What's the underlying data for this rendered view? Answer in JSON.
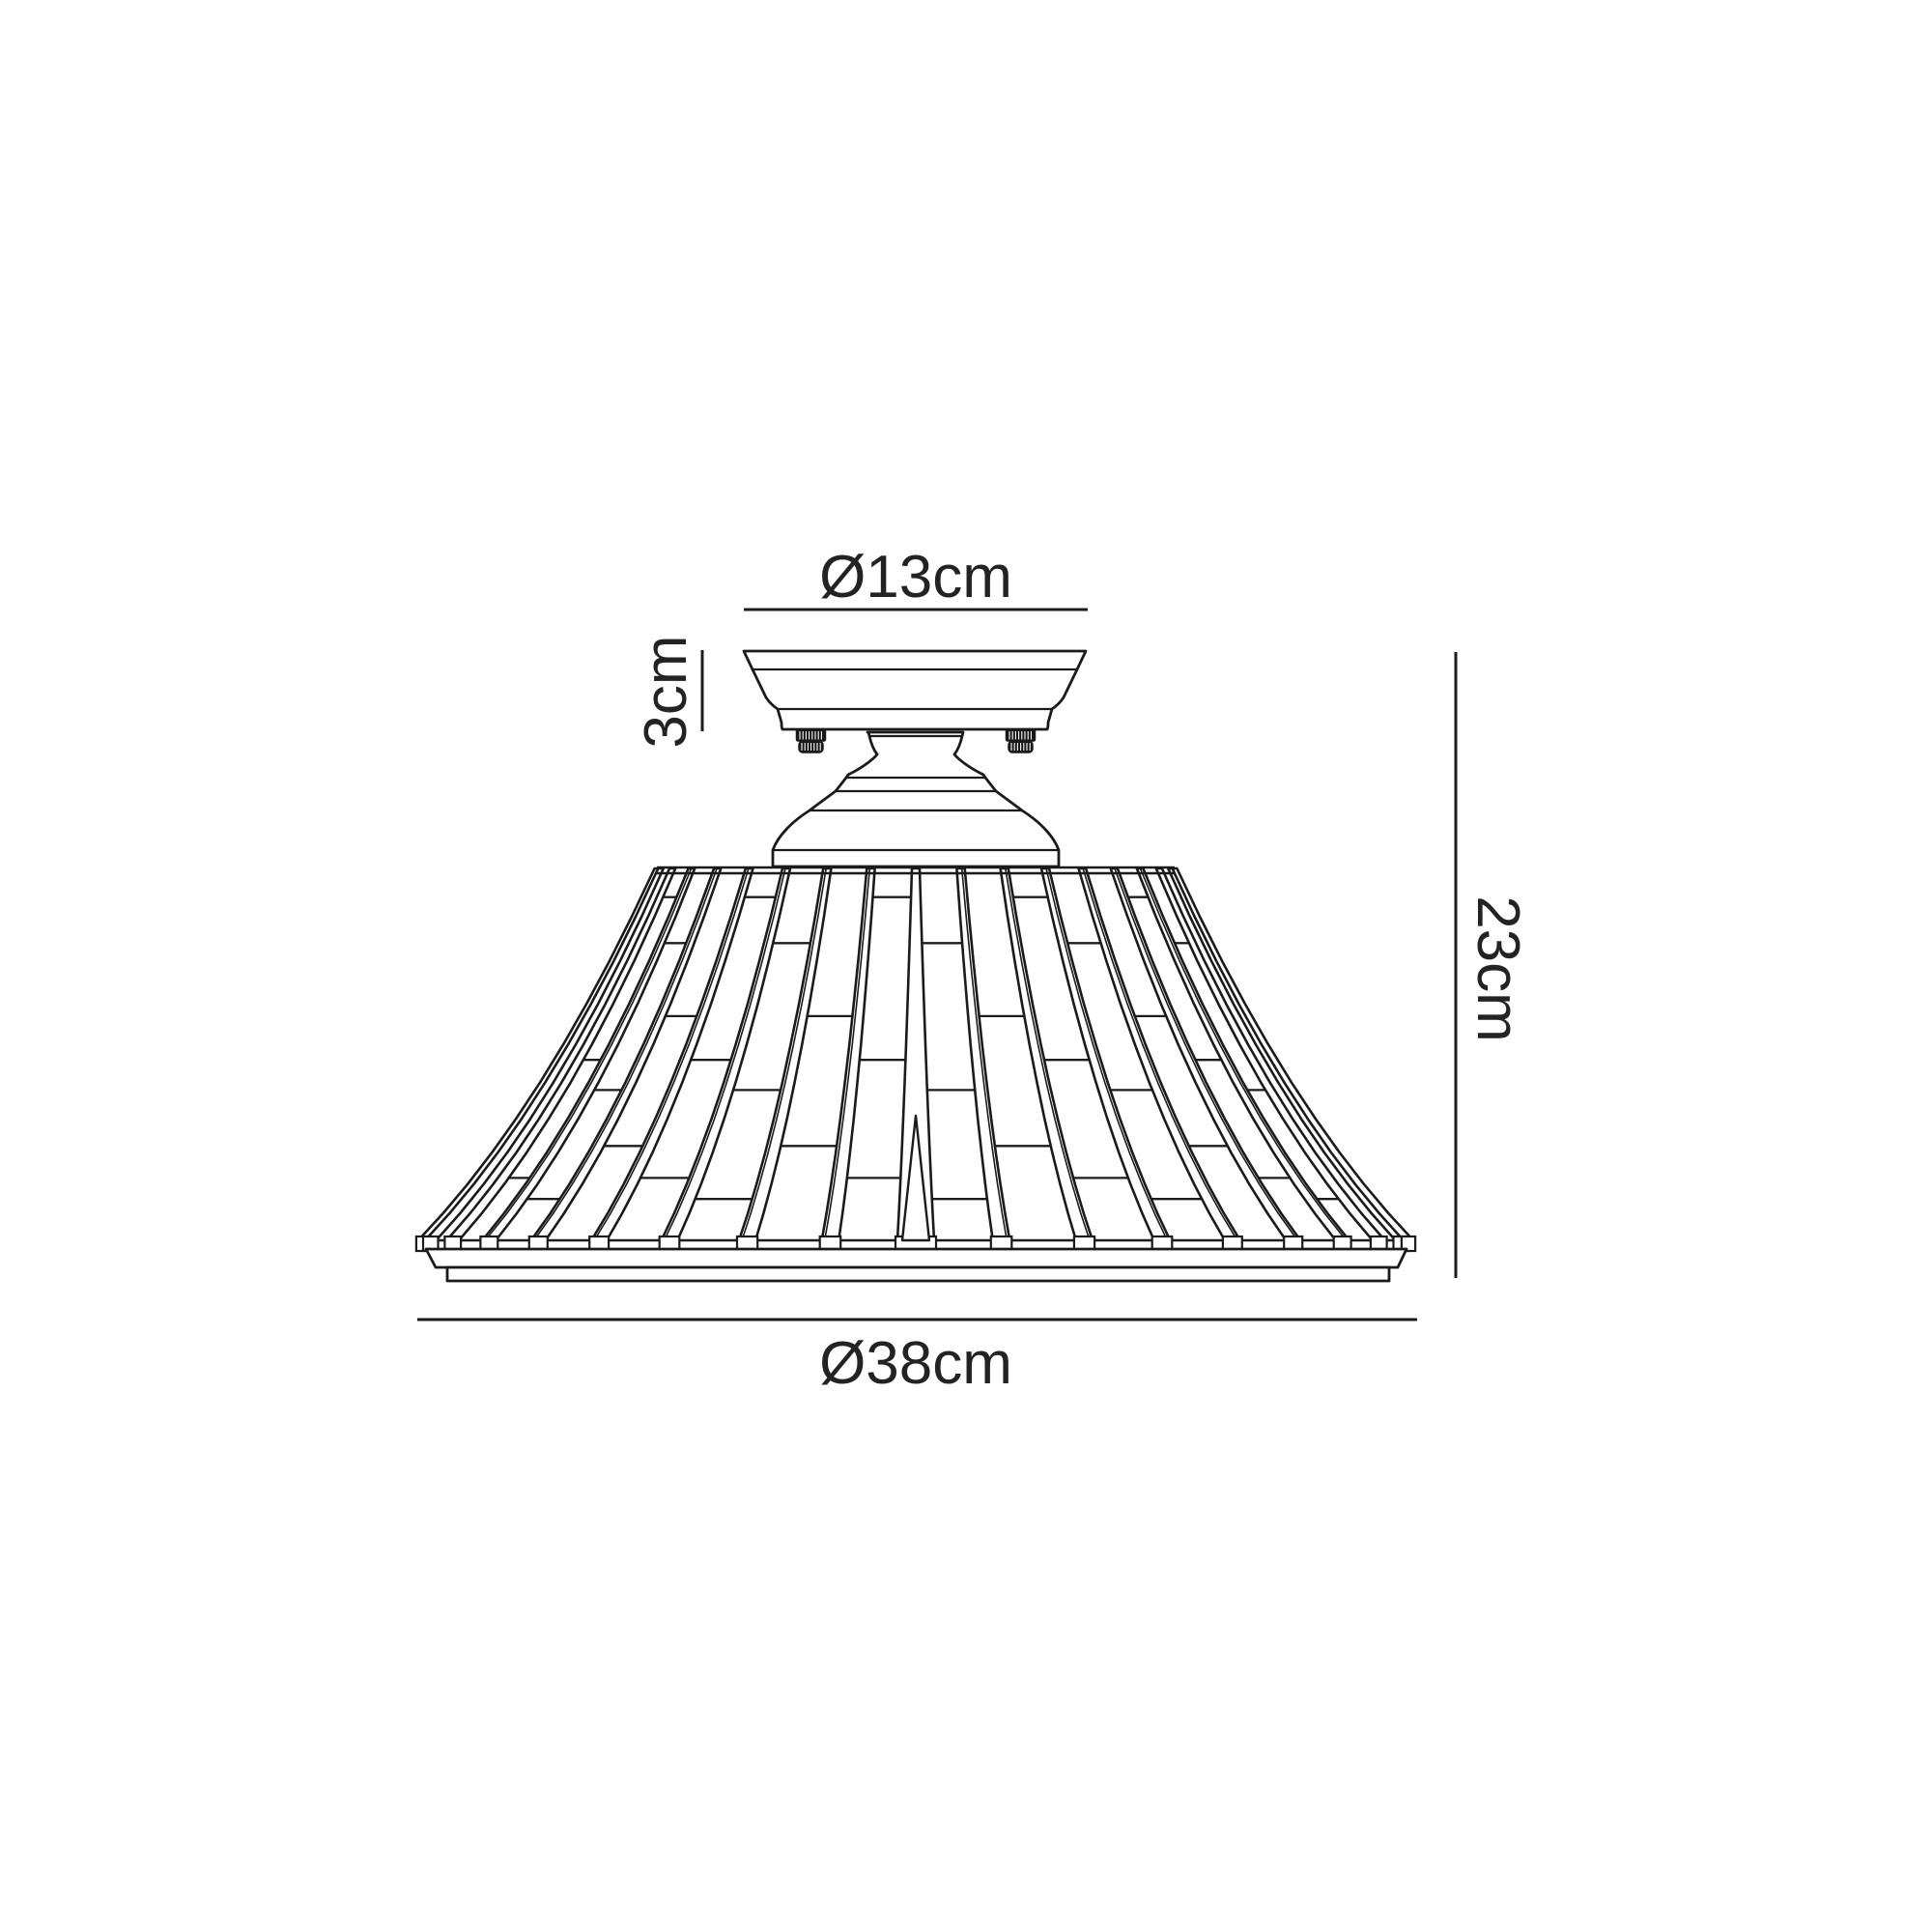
{
  "canvas": {
    "background": "#ffffff",
    "line_color": "#1b1b1b",
    "text_color": "#232323"
  },
  "dimensions": {
    "canopy_diameter": {
      "label": "Ø13cm",
      "value_cm": 13,
      "kind": "diameter",
      "applies_to": "ceiling canopy"
    },
    "canopy_height": {
      "label": "3cm",
      "value_cm": 3,
      "kind": "height",
      "applies_to": "ceiling canopy"
    },
    "overall_height": {
      "label": "23cm",
      "value_cm": 23,
      "kind": "height",
      "applies_to": "whole fixture"
    },
    "shade_diameter": {
      "label": "Ø38cm",
      "value_cm": 38,
      "kind": "diameter",
      "applies_to": "shade"
    }
  }
}
